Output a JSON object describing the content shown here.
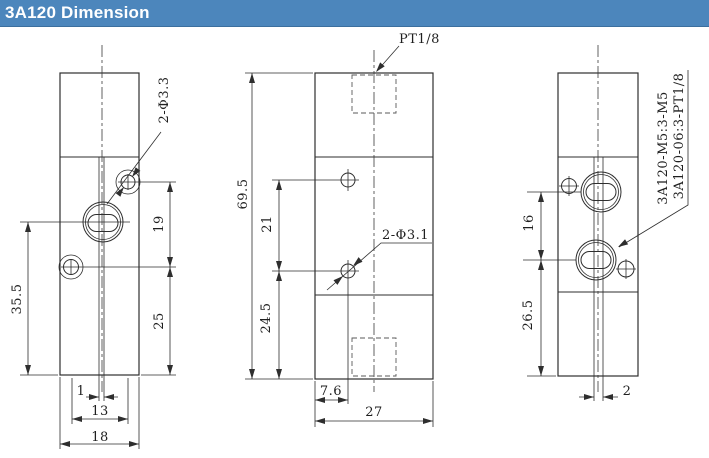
{
  "header": {
    "title": "3A120 Dimension",
    "background_color": "#4C86BC",
    "text_color": "#FFFFFF"
  },
  "drawing": {
    "line_color": "#2E2E2E",
    "views": {
      "front": {
        "dims": {
          "overall_height": "35.5",
          "hole_vertical_span": "19",
          "lower_height": "25",
          "slot_width": "1",
          "hole_horizontal_span": "13",
          "body_width": "18"
        },
        "callout_holes": "2-Φ3.3"
      },
      "side": {
        "dims": {
          "overall_height": "69.5",
          "upper_hole_offset": "21",
          "lower_hole_offset": "24.5",
          "hole_from_edge": "7.6",
          "body_width": "27"
        },
        "callout_port": "PT1/8",
        "callout_holes": "2-Φ3.1"
      },
      "back": {
        "dims": {
          "port_span": "16",
          "lower_height": "26.5",
          "slot_width": "2"
        },
        "model_m5": "3A120-M5:3-M5",
        "model_06": "3A120-06:3-PT1/8"
      }
    }
  }
}
